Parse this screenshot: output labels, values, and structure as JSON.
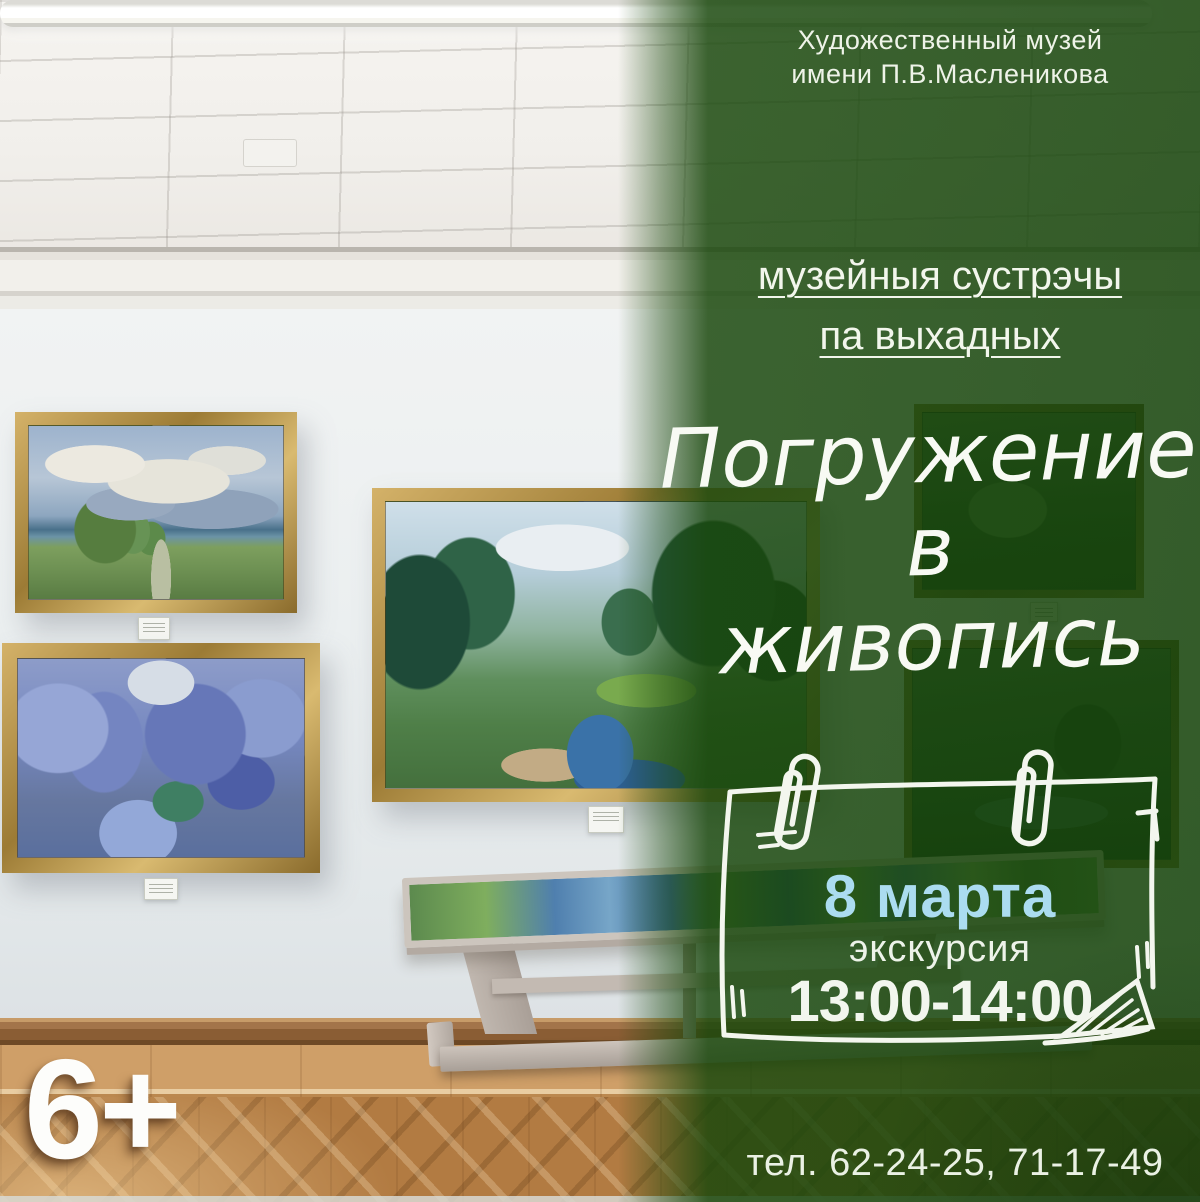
{
  "poster": {
    "museum": {
      "line1": "Художественный музей",
      "line2": "имени П.В.Масленикова"
    },
    "series": {
      "line1": "музейныя сустрэчы",
      "line2": "па выхадных"
    },
    "title": {
      "line1": "Погружение",
      "line2": "в",
      "line3": "живопись"
    },
    "event": {
      "date": "8 марта",
      "kind": "экскурсия",
      "time": "13:00-14:00"
    },
    "age_rating": "6+",
    "phone": "тел. 62-24-25, 71-17-49",
    "icons": {
      "paperclip_left": "paperclip-icon",
      "paperclip_right": "paperclip-icon",
      "calendar_frame": "hand-drawn-calendar-frame"
    },
    "colors": {
      "overlay_green": "#186007",
      "overlay_green_solid": "#2e5a23",
      "date_blue": "#abdcf0",
      "text_white": "#f5f8f1",
      "floor_wood": "#b27b42",
      "frame_gold": "#b08c45"
    }
  }
}
